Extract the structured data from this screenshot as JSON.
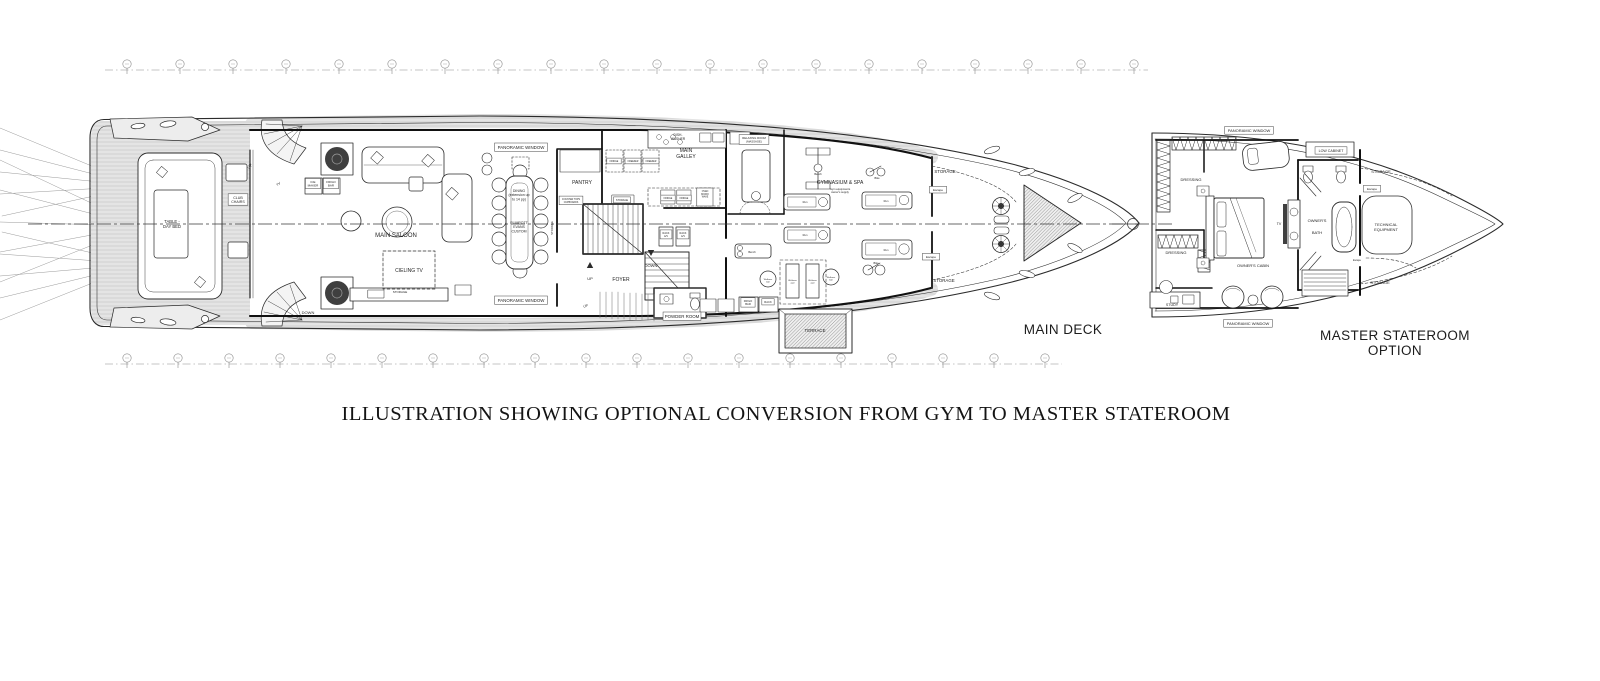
{
  "caption": {
    "text": "ILLUSTRATION SHOWING OPTIONAL CONVERSION FROM GYM TO MASTER STATEROOM"
  },
  "titles": {
    "main_deck": "MAIN DECK",
    "master_line1": "MASTER STATEROOM",
    "master_line2": "OPTION"
  },
  "diagram": {
    "colors": {
      "line": "#2b2b2b",
      "wall": "#111111",
      "grid": "#8a8a8a",
      "text": "#1f1f1f",
      "box_edge": "#444444"
    },
    "station_rows": [
      {
        "y": 70,
        "x1": 105,
        "x2": 1148,
        "markers": [
          127,
          180,
          233,
          286,
          339,
          392,
          445,
          498,
          551,
          604,
          657,
          710,
          763,
          816,
          869,
          922,
          975,
          1028,
          1081,
          1134
        ]
      },
      {
        "y": 364,
        "x1": 105,
        "x2": 1062,
        "markers": [
          127,
          178,
          229,
          280,
          331,
          382,
          433,
          484,
          535,
          586,
          637,
          688,
          739,
          790,
          841,
          892,
          943,
          994,
          1045
        ]
      }
    ],
    "centerlines": [
      {
        "x1": 28,
        "y": 224,
        "x2": 1140
      },
      {
        "x1": 1112,
        "y": 224,
        "x2": 1172,
        "circle_x": 1133
      }
    ],
    "labels": [
      {
        "id": "club-chairs-label",
        "lines": [
          "CLUB",
          "CHAIRS"
        ],
        "x": 238,
        "y": 199,
        "s": 3.6,
        "lh": 4.2,
        "box": true
      },
      {
        "id": "table-day-bed-label",
        "lines": [
          "TABLE -",
          "DAY BED"
        ],
        "x": 172,
        "y": 223,
        "s": 4.2,
        "lh": 5
      },
      {
        "id": "ice-maker-label",
        "lines": [
          "ICE",
          "MAKER"
        ],
        "x": 313,
        "y": 183,
        "s": 3,
        "lh": 3.6,
        "box": true
      },
      {
        "id": "frigo-bar-saloon-label",
        "lines": [
          "FRIGO",
          "BAR"
        ],
        "x": 331,
        "y": 183,
        "s": 3,
        "lh": 3.6,
        "box": true
      },
      {
        "id": "up-aft-label",
        "lines": [
          "UP"
        ],
        "x": 251,
        "y": 167,
        "s": 4,
        "rot": -55
      },
      {
        "id": "tv-aft-label",
        "lines": [
          "TV"
        ],
        "x": 279,
        "y": 185,
        "s": 3.4,
        "rot": -35
      },
      {
        "id": "down-aft-label",
        "lines": [
          "DOWN"
        ],
        "x": 308,
        "y": 314,
        "s": 4
      },
      {
        "id": "main-saloon-label",
        "lines": [
          "MAIN SALOON"
        ],
        "x": 396,
        "y": 237,
        "s": 6
      },
      {
        "id": "cieling-tv-label",
        "lines": [
          "CIELING TV"
        ],
        "x": 409,
        "y": 272,
        "s": 5
      },
      {
        "id": "storage-saloon-label",
        "lines": [
          "STORAGE"
        ],
        "x": 400,
        "y": 293,
        "s": 3
      },
      {
        "id": "panoramic-window-top-label",
        "lines": [
          "PANORAMIC WINDOW"
        ],
        "x": 521,
        "y": 149,
        "s": 4.4,
        "box": true
      },
      {
        "id": "panoramic-window-bottom-label",
        "lines": [
          "PANORAMIC WINDOW"
        ],
        "x": 521,
        "y": 302,
        "s": 4.4,
        "box": true
      },
      {
        "id": "dining-label",
        "lines": [
          "DINING",
          "(extension up",
          "to 14 pp)"
        ],
        "x": 519,
        "y": 192,
        "s": 3.5,
        "lh": 4.2
      },
      {
        "id": "dining-custom-label",
        "lines": [
          "PLIMPOTT",
          "EVANS",
          "CUSTOM"
        ],
        "x": 519,
        "y": 224,
        "s": 3.5,
        "lh": 4.2
      },
      {
        "id": "pantry-label",
        "lines": [
          "PANTRY"
        ],
        "x": 582,
        "y": 184,
        "s": 5
      },
      {
        "id": "counter-tops-label",
        "lines": [
          "COUNTER TOPS",
          "CUPBOARDS"
        ],
        "x": 571,
        "y": 200,
        "s": 2.3,
        "lh": 2.8,
        "box": true
      },
      {
        "id": "storage-pantry-label",
        "lines": [
          "STORAGE"
        ],
        "x": 622,
        "y": 201,
        "s": 2.5,
        "box": true
      },
      {
        "id": "storage-stair-label",
        "lines": [
          "STORAGE"
        ],
        "x": 553,
        "y": 228,
        "s": 2.8,
        "rot": -90
      },
      {
        "id": "dish-washer-label",
        "lines": [
          "DISH-",
          "WASHER"
        ],
        "x": 678,
        "y": 136,
        "s": 3.3,
        "lh": 3.8
      },
      {
        "id": "main-galley-label",
        "lines": [
          "MAIN",
          "GALLEY"
        ],
        "x": 686,
        "y": 152,
        "s": 5,
        "lh": 6
      },
      {
        "id": "fridge-1-label",
        "lines": [
          "FRIDGE"
        ],
        "x": 614,
        "y": 162,
        "s": 2.3,
        "box": true
      },
      {
        "id": "freezer-1-label",
        "lines": [
          "FREEZER"
        ],
        "x": 633,
        "y": 162,
        "s": 2.3,
        "box": true
      },
      {
        "id": "freezer-2-label",
        "lines": [
          "FREEZER"
        ],
        "x": 651,
        "y": 162,
        "s": 2.3,
        "box": true
      },
      {
        "id": "fridge-2-label",
        "lines": [
          "FRIDGE"
        ],
        "x": 668,
        "y": 199,
        "s": 2.3,
        "box": true
      },
      {
        "id": "fridge-3-label",
        "lines": [
          "FRIDGE"
        ],
        "x": 684,
        "y": 199,
        "s": 2.3,
        "box": true
      },
      {
        "id": "oven-label",
        "lines": [
          "OVEN",
          "MICRO",
          "WAVE"
        ],
        "x": 705,
        "y": 192,
        "s": 2.3,
        "lh": 2.8
      },
      {
        "id": "up-foyer-label",
        "lines": [
          "UP"
        ],
        "x": 590,
        "y": 280,
        "s": 4
      },
      {
        "id": "down-foyer-label",
        "lines": [
          "DOWN"
        ],
        "x": 651,
        "y": 267,
        "s": 4
      },
      {
        "id": "foyer-label",
        "lines": [
          "FOYER"
        ],
        "x": 621,
        "y": 281,
        "s": 5
      },
      {
        "id": "rack-av-1-label",
        "lines": [
          "RACK",
          "A/V"
        ],
        "x": 666,
        "y": 234,
        "s": 2.5,
        "lh": 3,
        "box": true
      },
      {
        "id": "rack-av-2-label",
        "lines": [
          "RACK",
          "A/V"
        ],
        "x": 683,
        "y": 234,
        "s": 2.5,
        "lh": 3,
        "box": true
      },
      {
        "id": "powder-room-label",
        "lines": [
          "POWDER ROOM"
        ],
        "x": 682,
        "y": 318,
        "s": 4.4,
        "box": true
      },
      {
        "id": "relaxing-room-label",
        "lines": [
          "RELAXING ROOM",
          "(MASSAGE)"
        ],
        "x": 754,
        "y": 139,
        "s": 2.8,
        "lh": 3.4,
        "box": true
      },
      {
        "id": "gymnasium-label",
        "lines": [
          "GYMNASIUM & SPA"
        ],
        "x": 840,
        "y": 184,
        "s": 5
      },
      {
        "id": "gym-sub-label",
        "lines": [
          "Gym equipments",
          "owner's supply"
        ],
        "x": 840,
        "y": 190,
        "s": 2.7,
        "lh": 3.2
      },
      {
        "id": "bench-top-label",
        "lines": [
          "Bench"
        ],
        "x": 818,
        "y": 175,
        "s": 2.6
      },
      {
        "id": "bike-top-label",
        "lines": [
          "Bike"
        ],
        "x": 877,
        "y": 179,
        "s": 2.6
      },
      {
        "id": "run-1-label",
        "lines": [
          "Run"
        ],
        "x": 805,
        "y": 203,
        "s": 2.6
      },
      {
        "id": "run-2-label",
        "lines": [
          "Run"
        ],
        "x": 886,
        "y": 202,
        "s": 2.6
      },
      {
        "id": "run-3-label",
        "lines": [
          "Run"
        ],
        "x": 805,
        "y": 236,
        "s": 2.6
      },
      {
        "id": "run-4-label",
        "lines": [
          "Run"
        ],
        "x": 886,
        "y": 251,
        "s": 2.6
      },
      {
        "id": "bench-bottom-label",
        "lines": [
          "Bench"
        ],
        "x": 752,
        "y": 253,
        "s": 2.6
      },
      {
        "id": "bike-bottom-label",
        "lines": [
          "Bike"
        ],
        "x": 876,
        "y": 264,
        "s": 2.6
      },
      {
        "id": "wellness-ball-1-label",
        "lines": [
          "Wellness",
          "ball"
        ],
        "x": 768,
        "y": 280,
        "s": 2.1,
        "lh": 2.6
      },
      {
        "id": "wellness-ball-2-label",
        "lines": [
          "Wellness",
          "ball"
        ],
        "x": 831,
        "y": 278,
        "s": 2.1,
        "lh": 2.6
      },
      {
        "id": "wellness-pad-1-label",
        "lines": [
          "Wellness",
          "pad"
        ],
        "x": 792.5,
        "y": 281,
        "s": 2.1,
        "lh": 2.6
      },
      {
        "id": "wellness-pad-2-label",
        "lines": [
          "Wellness",
          "pad"
        ],
        "x": 812.5,
        "y": 281,
        "s": 2.1,
        "lh": 2.6
      },
      {
        "id": "frigo-bar-gym-label",
        "lines": [
          "FRIGO",
          "BAR"
        ],
        "x": 748,
        "y": 302,
        "s": 2.7,
        "lh": 3.2,
        "box": true
      },
      {
        "id": "rack-gym-label",
        "lines": [
          "RACK"
        ],
        "x": 768,
        "y": 303,
        "s": 2.7,
        "box": true
      },
      {
        "id": "storage-bow-top-label",
        "lines": [
          "STORAGE"
        ],
        "x": 945,
        "y": 173,
        "s": 4.4
      },
      {
        "id": "storage-bow-bottom-label",
        "lines": [
          "STORAGE"
        ],
        "x": 944,
        "y": 282,
        "s": 4.4
      },
      {
        "id": "escape-bow-top-label",
        "lines": [
          "Escape"
        ],
        "x": 938,
        "y": 191,
        "s": 3,
        "box": true
      },
      {
        "id": "escape-bow-bottom-label",
        "lines": [
          "Escape"
        ],
        "x": 931,
        "y": 258,
        "s": 3,
        "box": true
      },
      {
        "id": "terrace-label",
        "lines": [
          "TERRACE"
        ],
        "x": 815,
        "y": 332,
        "s": 4.4
      },
      {
        "id": "up-side-deck-label",
        "lines": [
          "UP"
        ],
        "x": 586,
        "y": 307,
        "s": 3.4,
        "rot": -20
      },
      {
        "id": "panoramic-window-m-top-label",
        "lines": [
          "PANORAMIC WINDOW"
        ],
        "x": 1249,
        "y": 132,
        "s": 4,
        "box": true
      },
      {
        "id": "panoramic-window-m-bottom-label",
        "lines": [
          "PANORAMIC WINDOW"
        ],
        "x": 1248,
        "y": 325,
        "s": 4,
        "box": true
      },
      {
        "id": "dressing-top-label",
        "lines": [
          "DRESSING"
        ],
        "x": 1191,
        "y": 181,
        "s": 4
      },
      {
        "id": "dressing-bottom-label",
        "lines": [
          "DRESSING"
        ],
        "x": 1176,
        "y": 254,
        "s": 4
      },
      {
        "id": "low-cabinet-label",
        "lines": [
          "LOW CABINET"
        ],
        "x": 1331,
        "y": 152,
        "s": 3.6,
        "box": true
      },
      {
        "id": "tv-master-label",
        "lines": [
          "TV"
        ],
        "x": 1279,
        "y": 225,
        "s": 3.6
      },
      {
        "id": "owners-bath-label",
        "lines": [
          "OWNER'S",
          "BATH"
        ],
        "x": 1317,
        "y": 222,
        "s": 4,
        "lh": 12
      },
      {
        "id": "owners-cabin-label",
        "lines": [
          "OWNER'S CABIN"
        ],
        "x": 1253,
        "y": 267,
        "s": 4
      },
      {
        "id": "study-label",
        "lines": [
          "STUDY"
        ],
        "x": 1172,
        "y": 306,
        "s": 3.6
      },
      {
        "id": "technical-equipment-label",
        "lines": [
          "TECHNICAL",
          "EQUIPMENT"
        ],
        "x": 1386,
        "y": 226,
        "s": 4,
        "lh": 5
      },
      {
        "id": "storage-master-top-label",
        "lines": [
          "STORAGE"
        ],
        "x": 1381,
        "y": 173,
        "s": 4
      },
      {
        "id": "storage-master-bottom-label",
        "lines": [
          "STORAGE"
        ],
        "x": 1380,
        "y": 284,
        "s": 4
      },
      {
        "id": "escape-master-top-label",
        "lines": [
          "Escape"
        ],
        "x": 1372,
        "y": 190,
        "s": 3,
        "box": true
      },
      {
        "id": "escape-master-bottom-label",
        "lines": [
          "Escape"
        ],
        "x": 1357,
        "y": 261,
        "s": 2.4
      }
    ]
  }
}
